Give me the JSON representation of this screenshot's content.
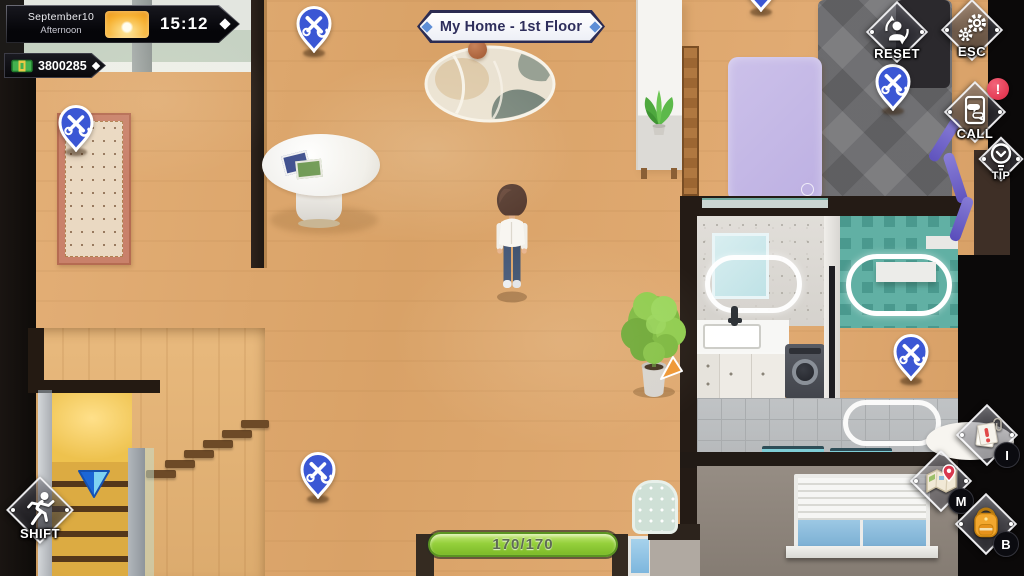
{
  "hud": {
    "date": "September10",
    "period": "Afternoon",
    "time": "15:12",
    "money_amount": "3800285",
    "location_title": "My Home - 1st Floor",
    "stamina": "170/170"
  },
  "buttons": {
    "reset_label": "RESET",
    "esc_label": "ESC",
    "call_label": "CALL",
    "call_alert": "!",
    "tip_label": "TIP",
    "shift_label": "SHIFT",
    "inventory_key": "I",
    "map_key": "M",
    "bag_key": "B"
  },
  "icons": {
    "weather": "sun-icon",
    "money": "cash-icon",
    "reset": "person-refresh-icon",
    "esc": "gears-icon",
    "call": "phone-chat-icon",
    "tip": "hint-circle-icon",
    "shift": "runner-icon",
    "inventory": "note-alert-icon",
    "map": "map-pin-icon",
    "bag": "backpack-icon",
    "repair_pin": "tools-pin-icon",
    "stairs_marker": "down-triangle-icon"
  },
  "colors": {
    "pin_blue": "#3b57d4",
    "stamina_green": "#95d03c",
    "title_navy": "#2e2e5c",
    "accent_diamond": "#5d8ed6",
    "alert_red": "#dd2742",
    "floor_wood": "#d9a268"
  }
}
